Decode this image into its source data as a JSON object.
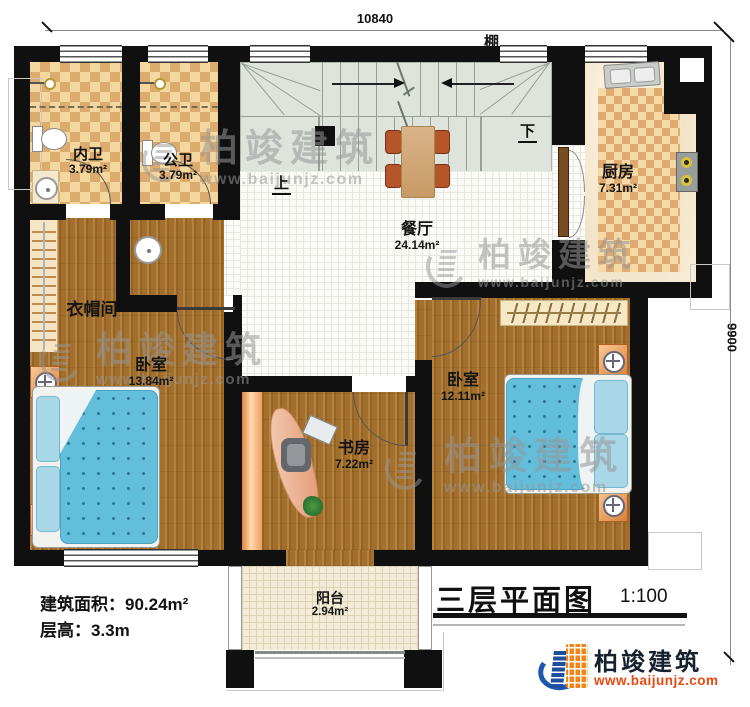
{
  "plan": {
    "dimensions": {
      "top": "10840",
      "right": "9900"
    },
    "canopy_label": "棚",
    "stair": {
      "up": "上",
      "down": "下"
    },
    "rooms": {
      "bath_private": {
        "name": "内卫",
        "area": "3.79m²"
      },
      "bath_public": {
        "name": "公卫",
        "area": "3.79m²"
      },
      "kitchen": {
        "name": "厨房",
        "area": "7.31m²"
      },
      "dining": {
        "name": "餐厅",
        "area": "24.14m²"
      },
      "cloakroom": {
        "name": "衣帽间"
      },
      "bedroom_left": {
        "name": "卧室",
        "area": "13.84m²"
      },
      "study": {
        "name": "书房",
        "area": "7.22m²"
      },
      "bedroom_right": {
        "name": "卧室",
        "area": "12.11m²"
      },
      "balcony": {
        "name": "阳台",
        "area": "2.94m²"
      }
    },
    "notes": [
      {
        "label": "建筑面积：",
        "value": "90.24m²"
      },
      {
        "label": "层高：",
        "value": "3.3m"
      }
    ],
    "title_block": {
      "title": "三层平面图",
      "scale": "1:100"
    },
    "brand": {
      "name": "柏竣建筑",
      "url": "www.baijunjz.com"
    },
    "watermark": {
      "name": "柏竣建筑",
      "url": "www.baijunjz.com"
    },
    "colors": {
      "wall": "#101010",
      "wood": "#a36f2c",
      "checker_dark": "#dcab6e",
      "stair": "#dee4db",
      "bed_blue": "#62bedb",
      "brand_blue": "#1d57b0",
      "brand_orange": "#f08519",
      "url_red": "#e8490f"
    }
  }
}
